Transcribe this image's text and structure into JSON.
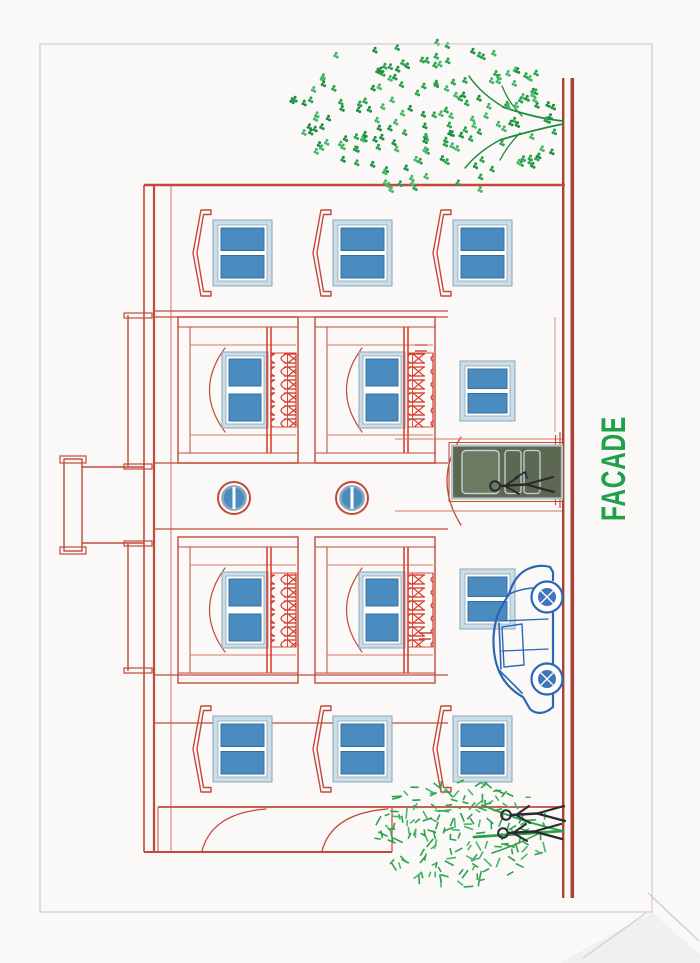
{
  "page": {
    "sheet_color": "#fbf9f8",
    "border_color": "#c9c3c9",
    "border_rect": {
      "x": 40,
      "y": 44,
      "w": 612,
      "h": 868
    },
    "fold_color": "#d3ccd0",
    "shade_color": "#efecee"
  },
  "label": {
    "text": "FACADE",
    "color": "#1fa04a",
    "font_size": 34,
    "x": 442,
    "y": 595
  },
  "palette": {
    "line": "#c24a38",
    "line_light": "#d4775f",
    "ornament": "#d63826",
    "ground": "#aa4136",
    "win_band": "#cddde7",
    "win_edge": "#89a6ba",
    "glass": "#4b8cc0",
    "glass_edge": "#336f9e",
    "door_dark": "#5d6852",
    "door_panel": "#6d7a62",
    "door_frame": "#b4c4c9",
    "door_light": "#c2d2d6",
    "tree_leaf1": "#2ca24d",
    "tree_leaf2": "#45b86a",
    "tree_leaf3": "#1f8f42",
    "tree_line": "#1d8a3c",
    "shrub_line": "#2f9e4b",
    "figure": "#2b2b2e",
    "car": "#2b66b5",
    "white": "#ffffff"
  },
  "drawing": {
    "canvas": {
      "w": 963,
      "h": 700
    },
    "ground": {
      "x0": 65,
      "x1": 885,
      "y_top": 562,
      "y_bot": 570.5
    },
    "building": {
      "left": 111,
      "right": 778,
      "parapet_y1": 144,
      "parapet_y2": 154,
      "cornice_y": 171,
      "left_wall_bottom": 392,
      "endwing": {
        "face_x": 156,
        "top_y": 158,
        "bottom_y": 565,
        "curves": [
          [
            202,
            266
          ],
          [
            322,
            388
          ]
        ]
      },
      "panel_lines_x": [
        240,
        288,
        434,
        500,
        646,
        652
      ],
      "panel_line_top": 155,
      "panel_line_bottom": 448
    },
    "roof": {
      "blocks": [
        {
          "x0": 292,
          "x1": 420
        },
        {
          "x0": 496,
          "x1": 648
        }
      ],
      "block_y_top": 128,
      "tower": {
        "x0": 420,
        "x1": 496,
        "shaft_top": 82,
        "cap": {
          "x": 412,
          "y": 64,
          "w": 92,
          "h": 18
        }
      }
    },
    "wing_windows": {
      "columns_cx": [
        214,
        710
      ],
      "floors_y": [
        213,
        333,
        453
      ],
      "w": 66,
      "h": 59,
      "bracket_w": 86,
      "bracket_gap": 21
    },
    "bays": {
      "x": [
        280,
        500
      ],
      "w": 146,
      "units_y": [
        178,
        315
      ],
      "unit_h": 120
    },
    "portholes": {
      "cx": 465,
      "cy": [
        234,
        352
      ],
      "r_outer": 16,
      "r_glass": 11.5
    },
    "ground_windows": [
      {
        "cx": 364,
        "y": 460
      },
      {
        "cx": 572,
        "y": 460
      }
    ],
    "entrance": {
      "arch": {
        "x0": 438,
        "x1": 526,
        "y": 461,
        "peak_y": 433
      },
      "door": {
        "x": 464.5,
        "y": 452,
        "w": 53,
        "h": 110
      },
      "jambs_x": [
        452,
        524
      ],
      "jamb_top": 395,
      "steps_y": [
        555.5,
        560
      ]
    },
    "wall_ticks": [
      {
        "x": 612,
        "y": 415
      },
      {
        "x": 324,
        "y": 419
      }
    ],
    "tree": {
      "cx": 845,
      "cy": 428,
      "rx": 76,
      "ry": 135,
      "clusters": 185,
      "base_x": 839
    },
    "shrub": {
      "cx": 131,
      "cy": 462,
      "rx": 55,
      "ry": 88,
      "strokes": 175
    },
    "car": {
      "x_front": 250,
      "x_rear": 398,
      "roof_y": 495,
      "wheel_front_cx": 284,
      "wheel_rear_cx": 366,
      "wheel_cy": 547,
      "wheel_r": 15.5
    },
    "pedestrians": [
      {
        "x": 130,
        "head_y": 503
      },
      {
        "x": 148,
        "head_y": 506
      }
    ],
    "door_person": {
      "x": 477,
      "head_y": 495
    }
  }
}
